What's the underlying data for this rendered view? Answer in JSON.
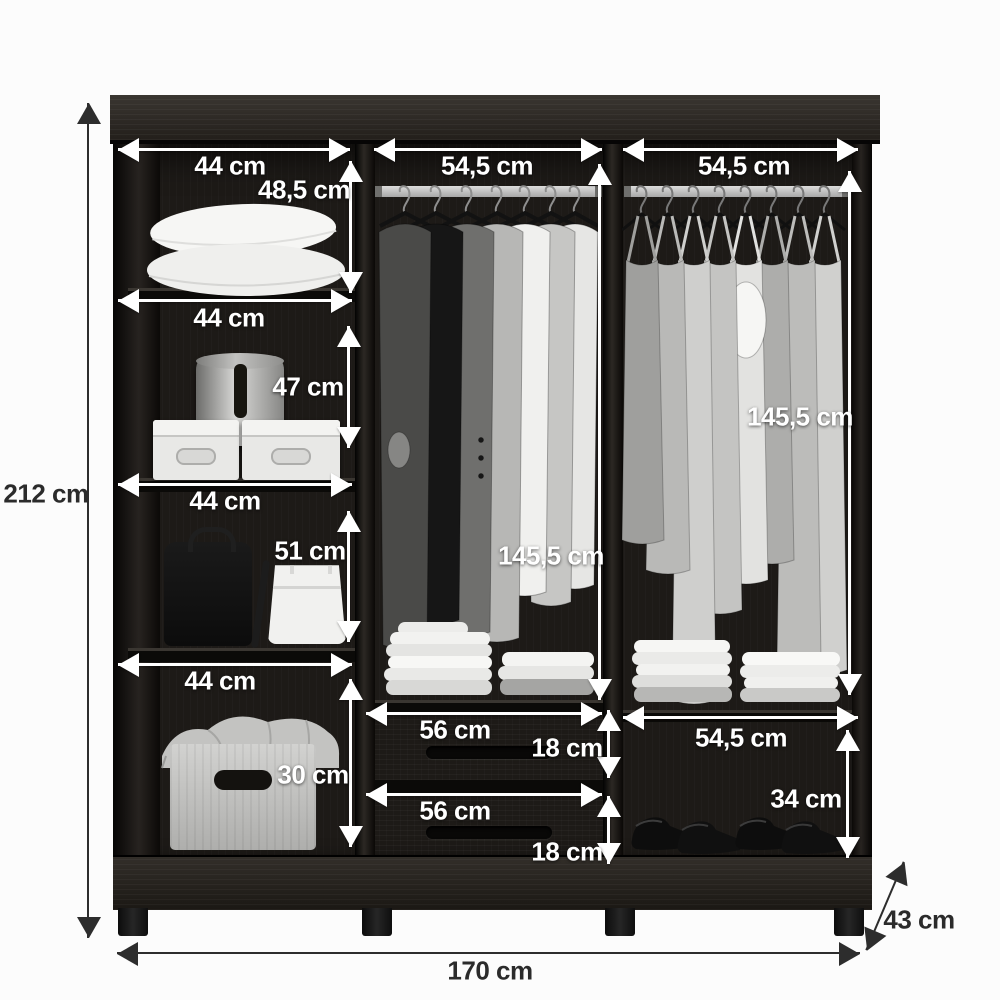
{
  "diagram_type": "wardrobe-dimension-diagram",
  "units": "cm",
  "palette": {
    "background": "#fcfcfc",
    "wood_dark": "#221f1c",
    "arrow_inside": "#ffffff",
    "arrow_outside": "#2d2d2d",
    "label_inside": "#ffffff",
    "label_outside": "#2b2b2b"
  },
  "overall": {
    "height_label": "212 cm",
    "width_label": "170 cm",
    "depth_label": "43 cm"
  },
  "left_column": {
    "shelf_width_labels": [
      "44 cm",
      "44 cm",
      "44 cm",
      "44 cm"
    ],
    "compartment_height_labels": [
      "48,5 cm",
      "47 cm",
      "51 cm",
      "30 cm"
    ],
    "contents": [
      "two-pillows",
      "hat-box",
      "two-storage-boxes",
      "backpack",
      "handbag",
      "basket-with-blanket"
    ]
  },
  "middle_column": {
    "top_width_label": "54,5 cm",
    "hanging_height_label": "145,5 cm",
    "drawer_width_labels": [
      "56 cm",
      "56 cm"
    ],
    "drawer_height_labels": [
      "18 cm",
      "18 cm"
    ],
    "contents": [
      "hanging-rod-with-jackets-and-shirts",
      "two-stacks-folded-clothes",
      "two-drawers"
    ]
  },
  "right_column": {
    "top_width_label": "54,5 cm",
    "hanging_height_label": "145,5 cm",
    "bottom_shelf_width_label": "54,5 cm",
    "shoe_compartment_height_label": "34 cm",
    "contents": [
      "hanging-rod-with-tops-and-dresses",
      "two-stacks-folded-clothes",
      "shoe-shelf-with-shoes"
    ]
  }
}
